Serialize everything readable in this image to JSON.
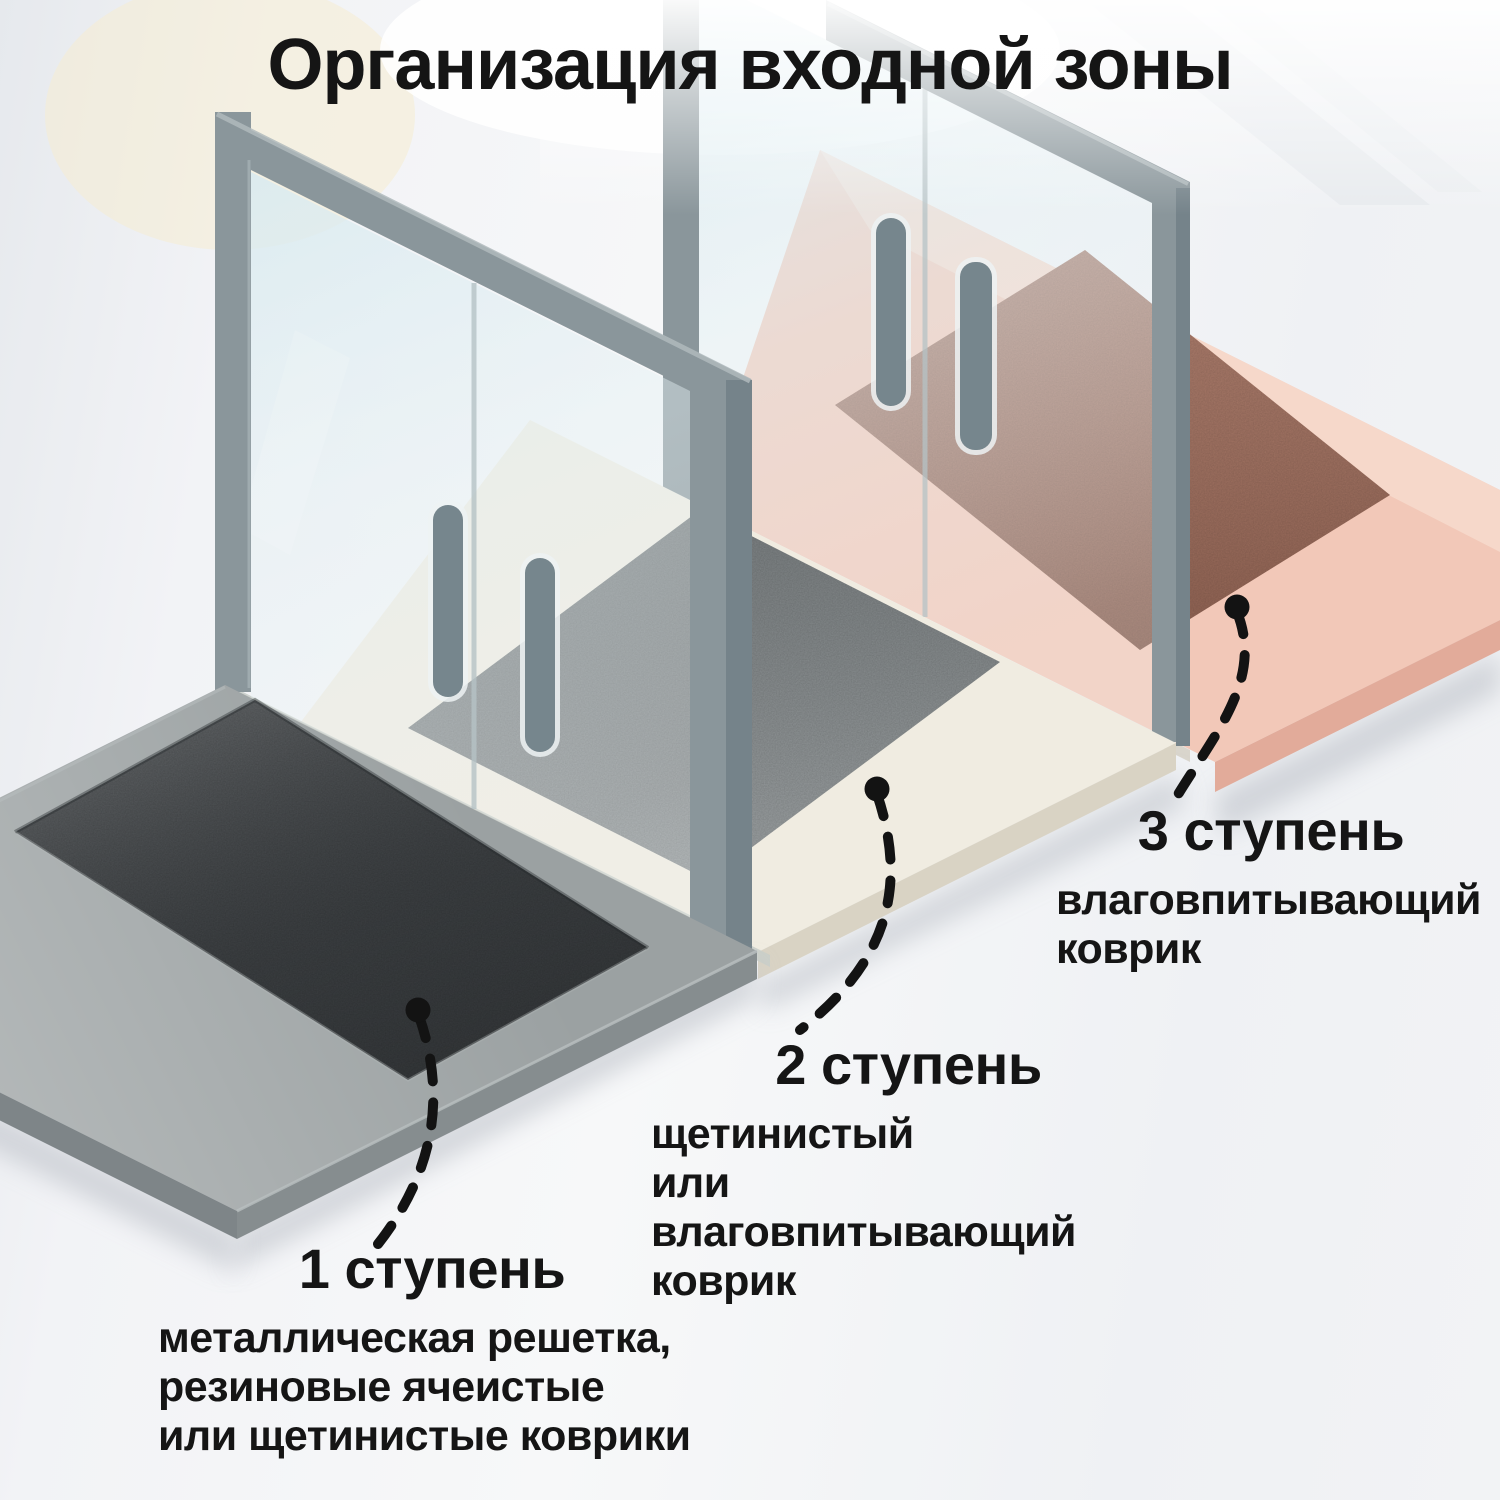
{
  "title": "Организация входной зоны",
  "callouts": [
    {
      "heading": "1 ступень",
      "description": "металлическая решетка,\nрезиновые ячеистые\nили щетинистые коврики"
    },
    {
      "heading": "2 ступень",
      "description": "щетинистый\nили влаговпитывающий\nковрик"
    },
    {
      "heading": "3 ступень",
      "description": "влаговпитывающий\nковрик"
    }
  ],
  "colors": {
    "text": "#151515",
    "background": "#eef0f3",
    "callout_line": "#131313",
    "platform": "#9ba1a2",
    "platform_face": "#868d8f",
    "platform_face_left": "#7e8588",
    "outdoor_mat": "#43474a",
    "vestibule_floor": "#f0ece1",
    "vestibule_floor_face": "#d9d3c4",
    "vestibule_mat": "#8f9597",
    "indoor_floor": "#f2c8b8",
    "indoor_floor_far": "#f6d8ca",
    "indoor_floor_face": "#e2ab9a",
    "indoor_mat": "#ab7562",
    "door_frame": "#8a969b",
    "door_frame_side": "#75838a",
    "glass_divider": "#b6c3c6",
    "handle": "#76868d",
    "handle_halo": "#edf2f3",
    "sill": "#c9cec9"
  }
}
